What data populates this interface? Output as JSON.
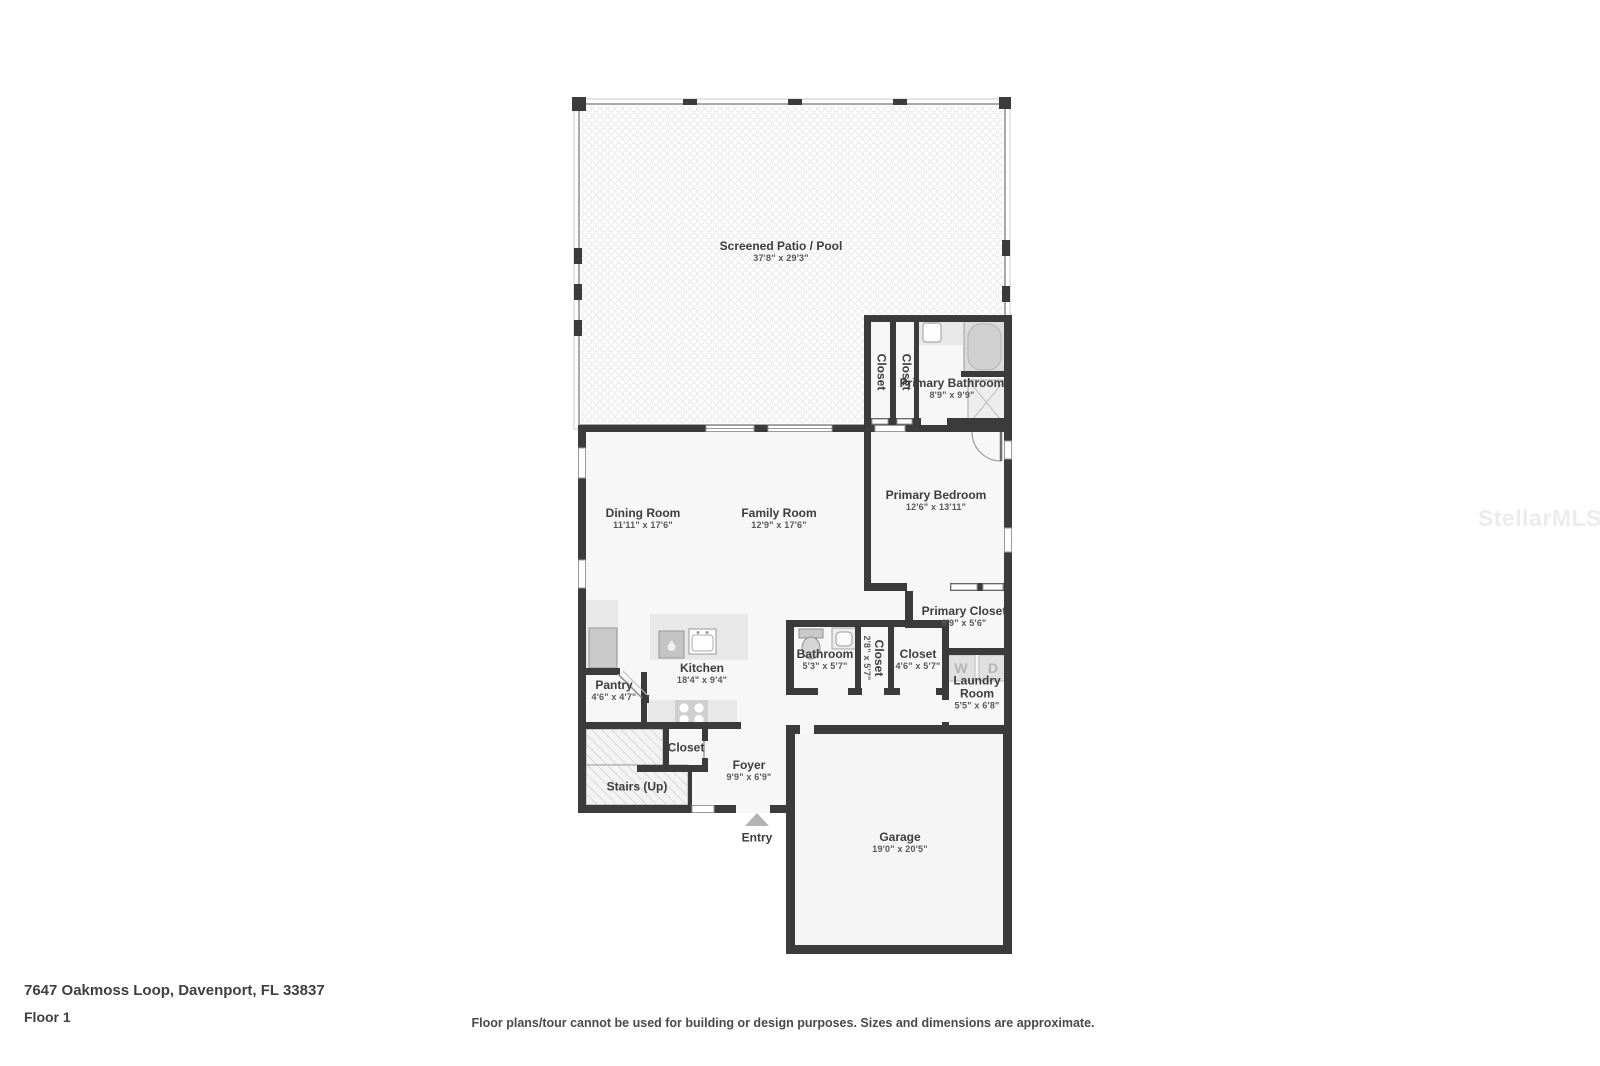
{
  "colors": {
    "wall": "#3b3b3b",
    "room_fill": "#f7f7f7",
    "garage_fill": "#f5f5f5",
    "patio_dot": "#e7e7e7",
    "fixture_gray": "#cfcfcf",
    "counter_gray": "#e8e8e8",
    "label_dark": "#3d3d3d",
    "dim_gray": "#585858",
    "window_outline": "#9a9a9a"
  },
  "watermark": "StellarMLS",
  "footer": {
    "address": "7647 Oakmoss Loop, Davenport, FL 33837",
    "floor_label": "Floor 1",
    "disclaimer": "Floor plans/tour cannot be used for building or design purposes. Sizes and dimensions are approximate."
  },
  "fixtures": {
    "washer": "W",
    "dryer": "D"
  },
  "rooms": {
    "patio": {
      "name": "Screened Patio / Pool",
      "dims": "37'8\" x 29'3\""
    },
    "primary_bathroom": {
      "name": "Primary Bathroom",
      "dims": "8'9\" x 9'9\""
    },
    "patio_closet_1": {
      "name": "Closet"
    },
    "patio_closet_2": {
      "name": "Closet"
    },
    "dining_room": {
      "name": "Dining Room",
      "dims": "11'11\" x 17'6\""
    },
    "family_room": {
      "name": "Family Room",
      "dims": "12'9\" x 17'6\""
    },
    "primary_bedroom": {
      "name": "Primary Bedroom",
      "dims": "12'6\" x 13'11\""
    },
    "primary_closet": {
      "name": "Primary Closet",
      "dims": "8'9\" x 5'6\""
    },
    "bathroom": {
      "name": "Bathroom",
      "dims": "5'3\" x 5'7\""
    },
    "hall_closet_small": {
      "name": "Closet",
      "dims": "2'8\" x 5'7\""
    },
    "hall_closet": {
      "name": "Closet",
      "dims": "4'6\" x 5'7\""
    },
    "laundry_room": {
      "name": "Laundry Room",
      "dims": "5'5\" x 6'8\""
    },
    "kitchen": {
      "name": "Kitchen",
      "dims": "18'4\" x 9'4\""
    },
    "pantry": {
      "name": "Pantry",
      "dims": "4'6\" x 4'7\""
    },
    "foyer_closet": {
      "name": "Closet"
    },
    "stairs": {
      "name": "Stairs (Up)"
    },
    "foyer": {
      "name": "Foyer",
      "dims": "9'9\" x 6'9\""
    },
    "entry": {
      "name": "Entry"
    },
    "garage": {
      "name": "Garage",
      "dims": "19'0\" x 20'5\""
    }
  }
}
